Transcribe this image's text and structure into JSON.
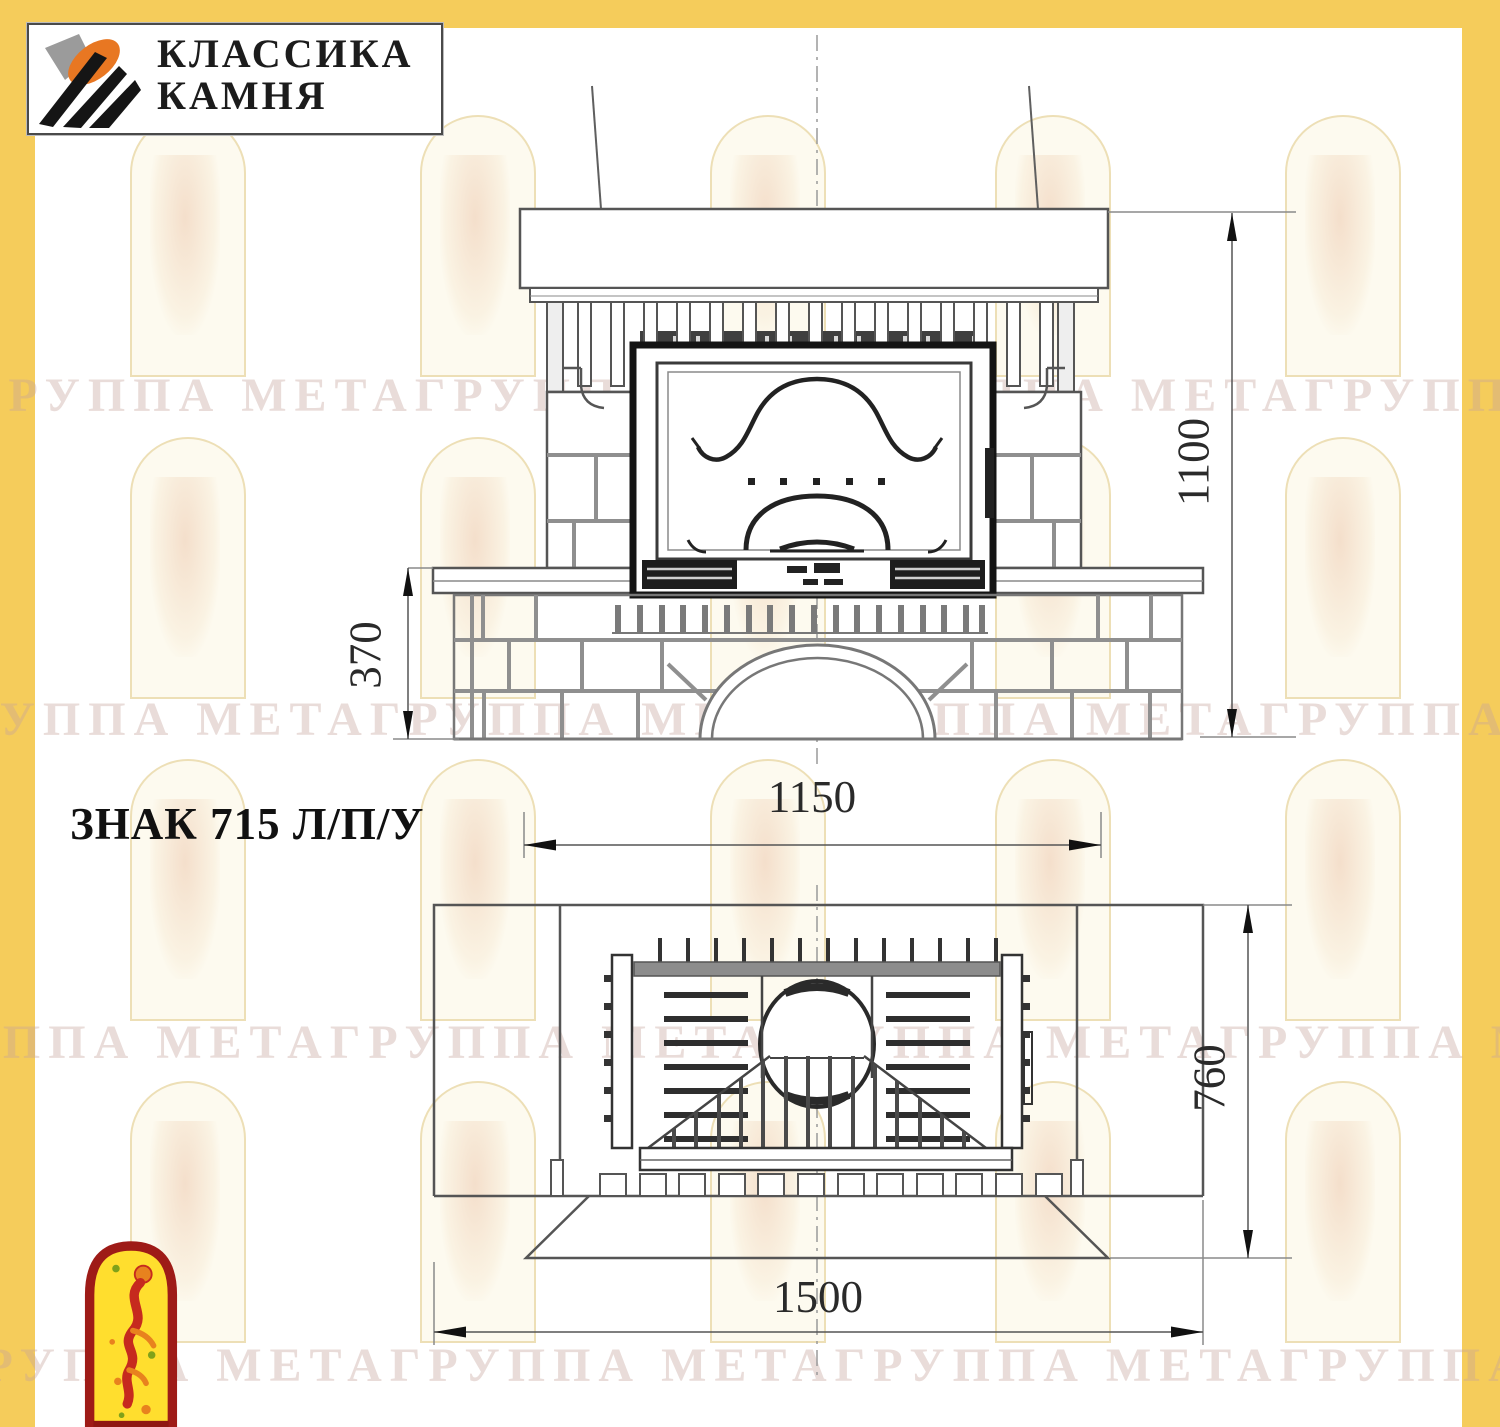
{
  "page": {
    "title": "ЗНАК 715 Л/П/У"
  },
  "logo": {
    "line1": "КЛАССИКА",
    "line2": "КАМНЯ"
  },
  "watermark": {
    "text": "ГРУППА МЕТАГРУППА МЕТАГРУППА МЕТАГРУППА МЕТА"
  },
  "front_view": {
    "dim_height": "1100",
    "dim_base_height": "370",
    "dim_width": "1150"
  },
  "plan_view": {
    "dim_depth": "760",
    "dim_width": "1500"
  },
  "colors": {
    "frame_yellow": "#F5CC5B",
    "emblem_red": "#9E1B17",
    "emblem_yellow": "#FFDE2E",
    "logo_orange": "#E87722"
  }
}
